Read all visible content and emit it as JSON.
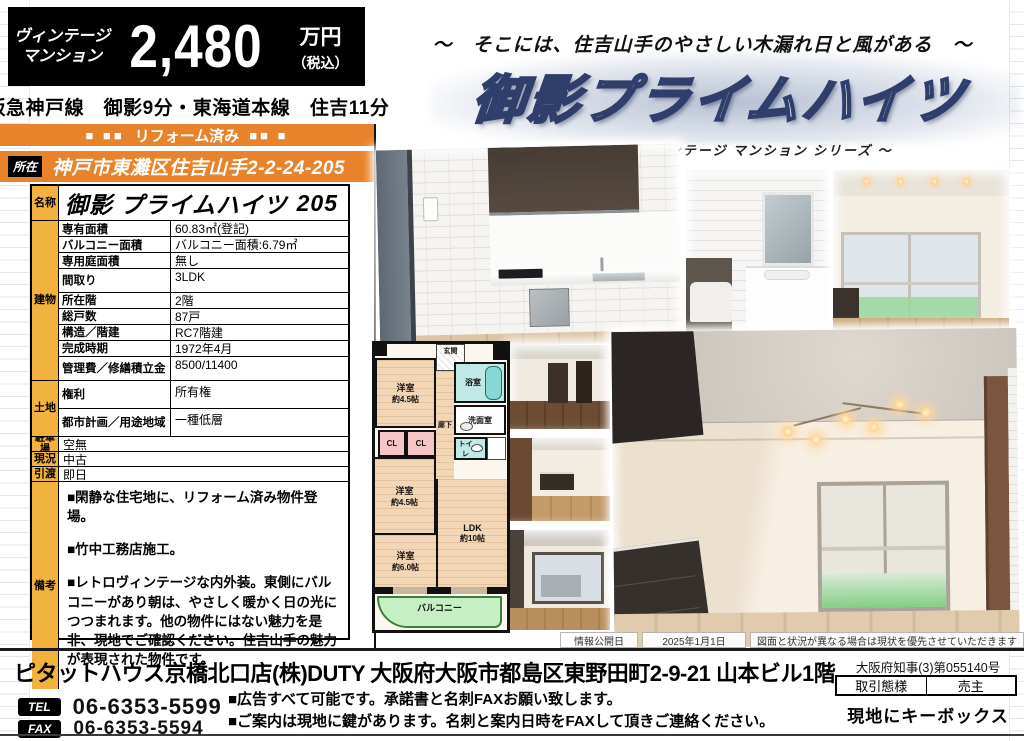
{
  "header": {
    "category_line1": "ヴィンテージ",
    "category_line2": "マンション",
    "price": "2,480",
    "price_unit": "万円",
    "price_tax": "（税込）",
    "access": "阪急神戸線　御影9分・東海道本線　住吉11分",
    "reform_label": "リフォーム済み",
    "squares_left": "■ ■■",
    "squares_right": "■■ ■",
    "location_label": "所在",
    "location_value": "神戸市東灘区住吉山手2-2-24-205"
  },
  "hero": {
    "tagline": "～　そこには、住吉山手のやさしい木漏れ日と風がある　～",
    "title": "御影プライムハイツ",
    "subtitle": "～ ヴィンテージ マンション シリーズ ～"
  },
  "table": {
    "name_label": "名称",
    "name_value": "御影 プライムハイツ",
    "name_room": "205",
    "building_label": "建物",
    "building_rows": [
      {
        "label": "専有面積",
        "value": "60.83㎡(登記)"
      },
      {
        "label": "バルコニー面積",
        "value": "バルコニー面積:6.79㎡"
      },
      {
        "label": "専用庭面積",
        "value": "無し"
      },
      {
        "label": "間取り",
        "value": "3LDK"
      },
      {
        "label": "所在階",
        "value": "2階"
      },
      {
        "label": "総戸数",
        "value": "87戸"
      },
      {
        "label": "構造／階建",
        "value": "RC7階建"
      },
      {
        "label": "完成時期",
        "value": "1972年4月"
      },
      {
        "label": "管理費／修繕積立金",
        "value": "8500/11400"
      }
    ],
    "land_label": "土地",
    "land_rows": [
      {
        "label": "権利",
        "value": "所有権"
      },
      {
        "label": "都市計画／用途地域",
        "value": "一種低層"
      }
    ],
    "simple_rows": [
      {
        "label": "駐車場",
        "value": "空無"
      },
      {
        "label": "現況",
        "value": "中古"
      },
      {
        "label": "引渡",
        "value": "即日"
      }
    ],
    "notes_label": "備考",
    "notes": [
      "■閑静な住宅地に、リフォーム済み物件登場。",
      "■竹中工務店施工。",
      "■レトロヴィンテージな内外装。東側にバルコニーがあり朝は、やさしく暖かく日の光につつまれます。他の物件にはない魅力を是非、現地でご確認ください。住吉山手の魅力が表現された物件です。"
    ]
  },
  "floorplan": {
    "entrance": "玄関",
    "bath": "浴室",
    "washroom": "洗面室",
    "toilet": "トイレ",
    "hallway": "廊下",
    "closet1": "CL",
    "closet2": "CL",
    "room1": "洋室",
    "room1_size": "約4.5帖",
    "room2": "洋室",
    "room2_size": "約4.5帖",
    "room3": "洋室",
    "room3_size": "約6.0帖",
    "ldk": "LDK",
    "ldk_size": "約10帖",
    "balcony": "バルコニー"
  },
  "info_bar": {
    "date_label": "情報公開日",
    "date_value": "2025年1月1日",
    "disclaimer": "図面と状況が異なる場合は現状を優先させていただきます"
  },
  "footer": {
    "company": "ピタットハウス京橋北口店(株)DUTY 大阪府大阪市都島区東野田町2-9-21 山本ビル1階",
    "tel_label": "TEL",
    "tel": "06-6353-5599",
    "fax_label": "FAX",
    "fax": "06-6353-5594",
    "note1": "■広告すべて可能です。承諾書と名刺FAXお願い致します。",
    "note2": "■ご案内は現地に鍵があります。名刺と案内日時をFAXして頂きご連絡ください。",
    "license": "大阪府知事(3)第055140号",
    "deal_type_label": "取引態様",
    "deal_type_value": "売主",
    "keybox": "現地にキーボックス"
  },
  "colors": {
    "accent_orange": "#E8832C",
    "label_yellow": "#F2B23D",
    "price_box_black": "#000000",
    "title_outline_navy": "#2F3E6A",
    "balcony_green": "#C6EFC4",
    "bath_teal": "#BFE8E6",
    "closet_pink": "#F6C6C6",
    "plan_floor_tan": "#F2D6B6"
  }
}
